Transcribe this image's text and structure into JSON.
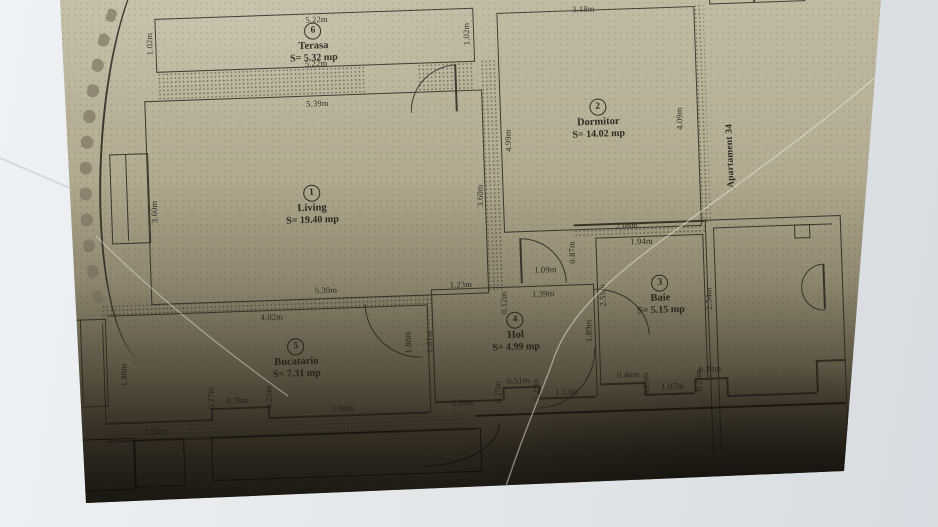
{
  "photo": {
    "description": "Photograph of a paper architectural floor plan",
    "background_color": "#e4e8eb",
    "paper_color": "#b4ad94",
    "ink_color": "#3a362b"
  },
  "plan": {
    "apartment_label": "Apartament 34",
    "rooms": {
      "terasa": {
        "number": "6",
        "name": "Terasa",
        "area": "S= 5.32 mp"
      },
      "dormitor": {
        "number": "2",
        "name": "Dormitor",
        "area": "S= 14.02 mp"
      },
      "living": {
        "number": "1",
        "name": "Living",
        "area": "S= 19.40 mp"
      },
      "bucatario": {
        "number": "5",
        "name": "Bucatario",
        "area": "S= 7.31 mp"
      },
      "hol": {
        "number": "4",
        "name": "Hol",
        "area": "S= 4.99 mp"
      },
      "baie": {
        "number": "3",
        "name": "Baie",
        "area": "S= 5.15 mp"
      }
    },
    "dimensions": {
      "t_top": "5.22m",
      "t_bot": "5.22m",
      "t_lv": "1.02m",
      "t_rv": "1.02m",
      "d_top": "3.18m",
      "d_rv": "4.09m",
      "d_lv": "4.99m",
      "l_top": "5.39m",
      "l_lv": "3.60m",
      "l_rv": "3.60m",
      "l_bot": "5.39m",
      "k_top": "4.02m",
      "k_lv": "1.88m",
      "k_rv1": "1.88m",
      "k_rv2": "2.01m",
      "k_027": "0.27m",
      "k_078": "0.78m",
      "k_025": "0.25m",
      "k_126": "1.26m",
      "k_198": "1.98m",
      "h_123": "1.23m",
      "h_012": "0.12m",
      "h_139": "1.39m",
      "h_109": "1.09m",
      "h_087": "0.87m",
      "h_099": "0.99m",
      "h_025a": "0.25m",
      "h_051": "0.51m",
      "h_025b": "0.25m",
      "h_113": "1.13m",
      "b_208": "2.08m",
      "b_194": "1.94m",
      "b_255": "2.55m",
      "b_189": "1.89m",
      "b_254": "2.54m",
      "r_046": "0.46m",
      "r_025a": "0.25m",
      "r_107": "1.07m",
      "r_025b": "0.25m",
      "r_038": "0.38m"
    }
  }
}
